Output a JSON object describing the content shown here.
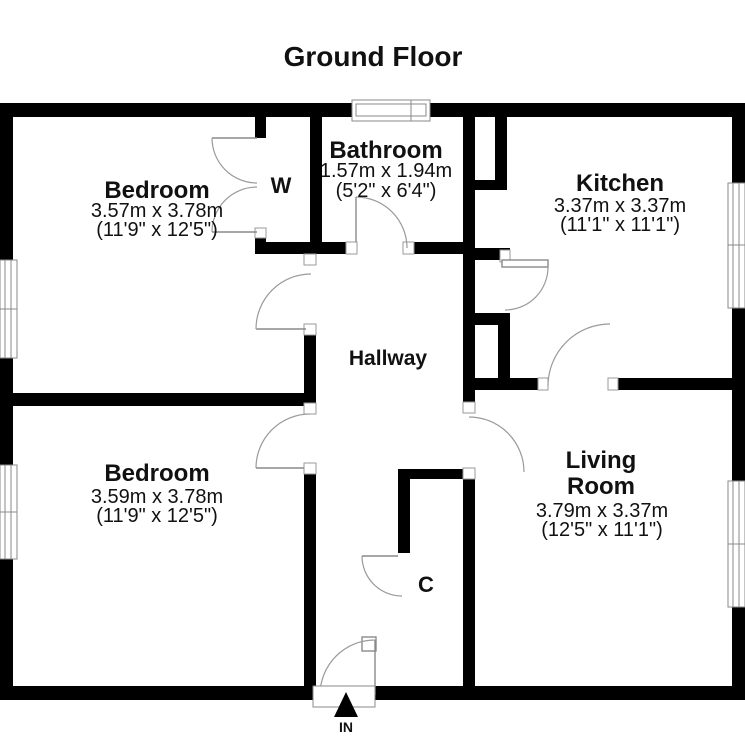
{
  "title": "Ground Floor",
  "rooms": {
    "bedroom1": {
      "name": "Bedroom",
      "metric": "3.57m x 3.78m",
      "imperial": "(11'9\" x 12'5\")"
    },
    "bathroom": {
      "name": "Bathroom",
      "metric": "1.57m x 1.94m",
      "imperial": "(5'2\" x 6'4\")"
    },
    "kitchen": {
      "name": "Kitchen",
      "metric": "3.37m x 3.37m",
      "imperial": "(11'1\" x 11'1\")"
    },
    "hallway": {
      "name": "Hallway"
    },
    "bedroom2": {
      "name": "Bedroom",
      "metric": "3.59m x 3.78m",
      "imperial": "(11'9\" x 12'5\")"
    },
    "living_room": {
      "name_line1": "Living",
      "name_line2": "Room",
      "metric": "3.79m x 3.37m",
      "imperial": "(12'5\" x 11'1\")"
    }
  },
  "labels": {
    "wardrobe": "W",
    "cupboard": "C",
    "entrance": "IN"
  },
  "colors": {
    "wall": "#000000",
    "background": "#ffffff",
    "door_arc": "#9a9a9a",
    "text": "#111111"
  }
}
